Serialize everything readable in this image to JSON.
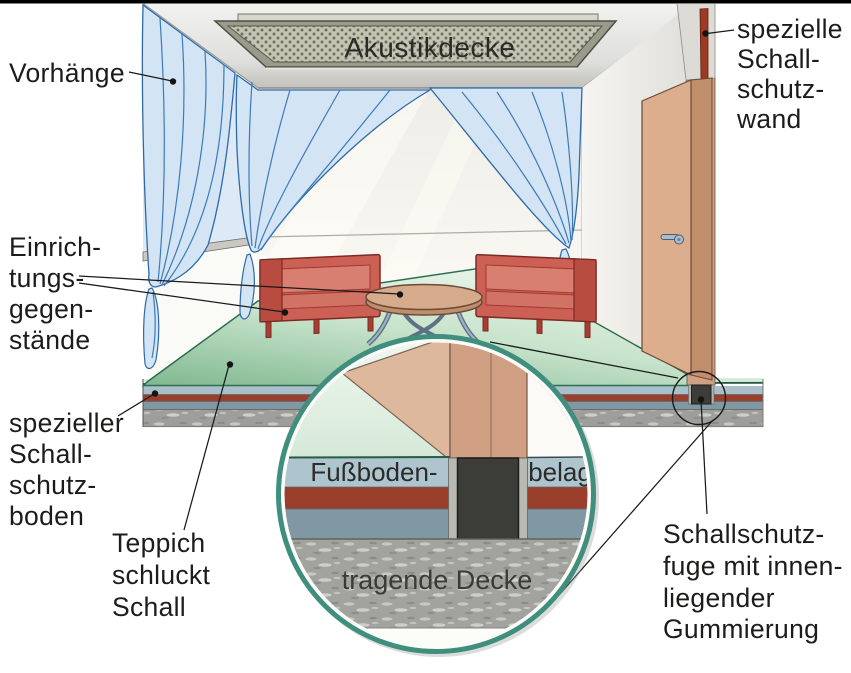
{
  "labels": {
    "curtains": "Vorhänge",
    "furnishings_lines": [
      "Einrich-",
      "tungs-",
      "gegen-",
      "stände"
    ],
    "soundproof_floor_lines": [
      "spezieller",
      "Schall-",
      "schutz-",
      "boden"
    ],
    "carpet_lines": [
      "Teppich",
      "schluckt",
      "Schall"
    ],
    "soundproof_wall_lines": [
      "spezielle",
      "Schall-",
      "schutz-",
      "wand"
    ],
    "joint_lines": [
      "Schallschutz-",
      "fuge mit innen-",
      "liegender",
      "Gummierung"
    ],
    "acoustic_ceiling": "Akustikdecke"
  },
  "magnifier": {
    "floor_covering_left": "Fußboden-",
    "floor_covering_right": "belag",
    "load_bearing_slab": "tragende Decke"
  },
  "colors": {
    "curtain_fill": "#d3e4f4",
    "curtain_line": "#3d7ab8",
    "carpet_green": "#9ccaa8",
    "chair_red": "#cd6054",
    "table_wood": "#d6ab8b",
    "door_tan": "#dcae8f",
    "wall_tan": "#cfa084",
    "soundproof_layer_red": "#9a3f2c",
    "floor_layer_light_blue": "#a9bfca",
    "floor_layer_dark_blue": "#8098a4",
    "concrete_gray": "#9e9e9a",
    "joint_dark": "#3c3c38",
    "magnifier_ring_teal": "#3f8e7e",
    "acoustic_panel_olive": "#c3c4b2",
    "text": "#1c1c1b"
  }
}
